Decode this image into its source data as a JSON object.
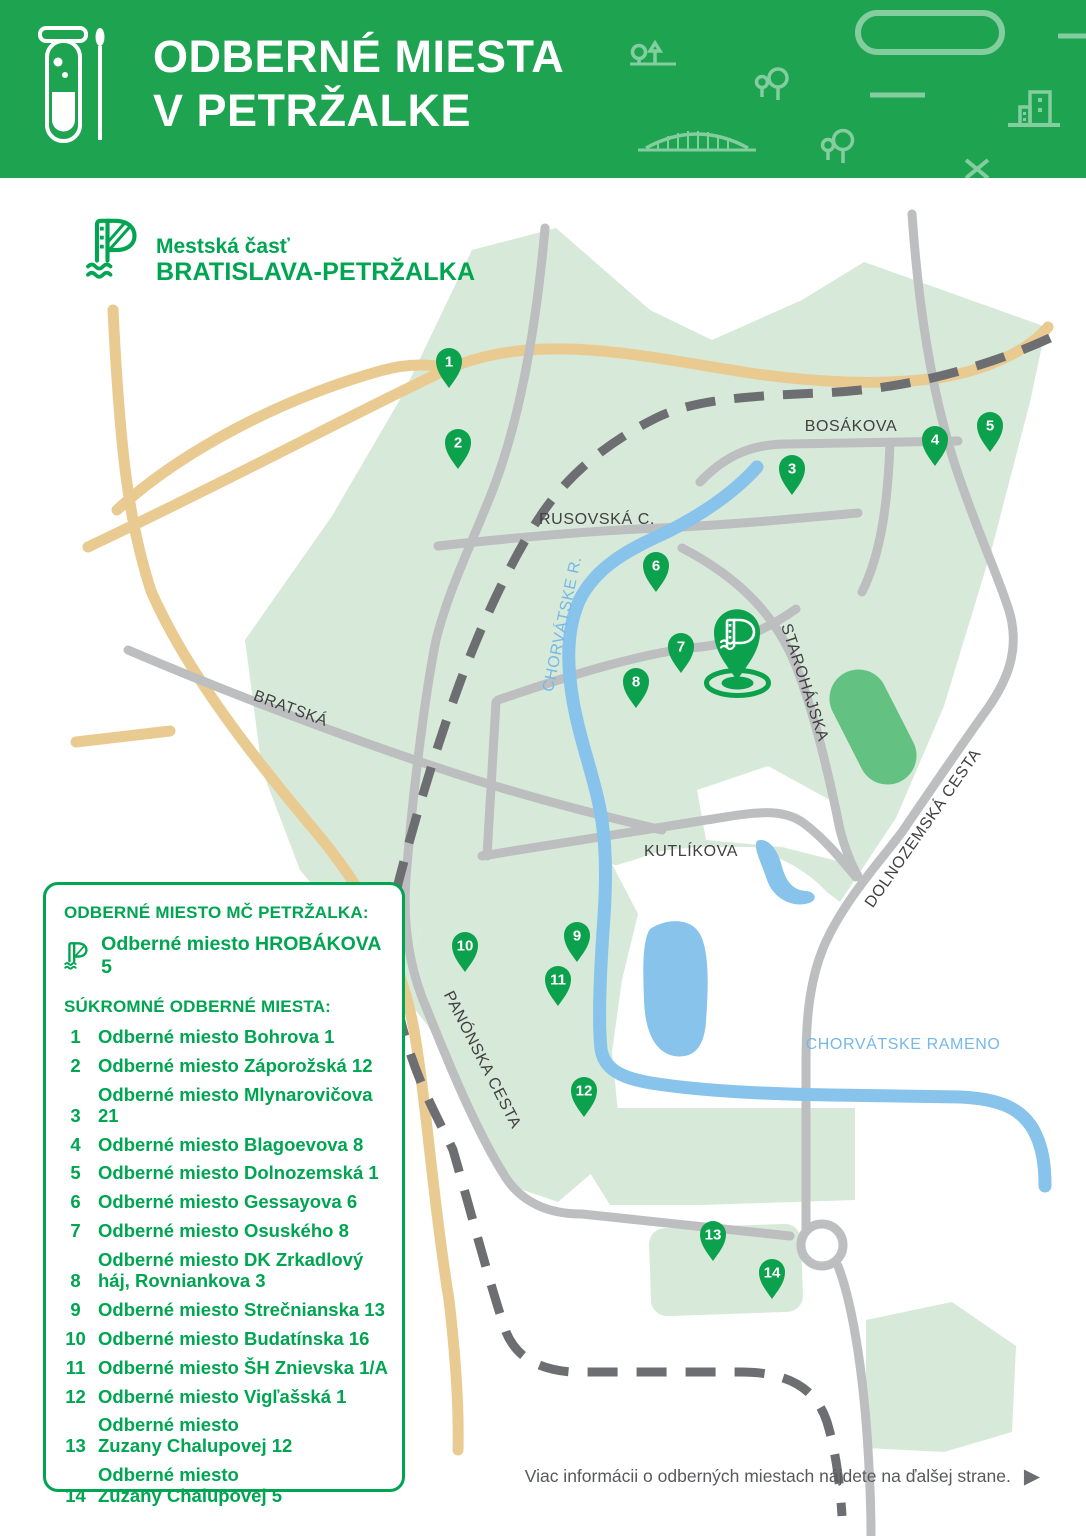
{
  "header": {
    "title_line1": "ODBERNÉ MIESTA",
    "title_line2": "V PETRŽALKE",
    "icons": [
      "test-tube",
      "swab",
      "tree-pine",
      "pill-shape",
      "trees",
      "buildings",
      "bridge",
      "cross-mark"
    ]
  },
  "brand": {
    "name_line1": "Mestská časť",
    "name_line2": "BRATISLAVA-PETRŽALKA"
  },
  "map": {
    "streets": [
      {
        "name": "BOSÁKOVA"
      },
      {
        "name": "RUSOVSKÁ C."
      },
      {
        "name": "BRATSKÁ"
      },
      {
        "name": "STAROHÁJSKA"
      },
      {
        "name": "KUTLÍKOVA"
      },
      {
        "name": "DOLNOZEMSKÁ CESTA"
      },
      {
        "name": "PANÓNSKA CESTA"
      }
    ],
    "waters": [
      {
        "name": "CHORVÁTSKE R."
      },
      {
        "name": "CHORVÁTSKE RAMENO"
      }
    ],
    "pins": [
      {
        "label": "1"
      },
      {
        "label": "2"
      },
      {
        "label": "3"
      },
      {
        "label": "4"
      },
      {
        "label": "5"
      },
      {
        "label": "6"
      },
      {
        "label": "7"
      },
      {
        "label": "8"
      },
      {
        "label": "9"
      },
      {
        "label": "10"
      },
      {
        "label": "11"
      },
      {
        "label": "12"
      },
      {
        "label": "13"
      },
      {
        "label": "14"
      }
    ],
    "main_pin": {
      "icon": "petrzalka-logo-pin"
    }
  },
  "legend": {
    "title_public": "ODBERNÉ MIESTO MČ PETRŽALKA:",
    "public_item": "Odberné miesto HROBÁKOVA 5",
    "title_private": "SÚKROMNÉ ODBERNÉ MIESTA:",
    "items": [
      {
        "num": "1",
        "line1": "Odberné miesto Bohrova 1"
      },
      {
        "num": "2",
        "line1": "Odberné miesto Záporožská 12"
      },
      {
        "num": "3",
        "line1": "Odberné miesto Mlynarovičova 21"
      },
      {
        "num": "4",
        "line1": "Odberné miesto Blagoevova 8"
      },
      {
        "num": "5",
        "line1": "Odberné miesto Dolnozemská 1"
      },
      {
        "num": "6",
        "line1": "Odberné miesto Gessayova 6"
      },
      {
        "num": "7",
        "line1": "Odberné miesto Osuského 8"
      },
      {
        "num": "8",
        "line1": "Odberné miesto DK Zrkadlový",
        "line2": "háj, Rovniankova 3"
      },
      {
        "num": "9",
        "line1": "Odberné miesto Strečnianska 13"
      },
      {
        "num": "10",
        "line1": "Odberné miesto Budatínska 16"
      },
      {
        "num": "11",
        "line1": "Odberné miesto ŠH Znievska 1/A"
      },
      {
        "num": "12",
        "line1": "Odberné miesto Vigľašská 1"
      },
      {
        "num": "13",
        "line1": "Odberné miesto",
        "line2": "Zuzany Chalupovej 12"
      },
      {
        "num": "14",
        "line1": "Odberné miesto",
        "line2": "Zuzany Chalupovej 5"
      }
    ]
  },
  "footer": {
    "note": "Viac informácii o odberných miestach nájdete na ďalšej strane.",
    "arrow": "▶"
  },
  "colors": {
    "header_green": "#1EA351",
    "brand_green": "#00A551",
    "pin_green": "#0CA14C",
    "district_green": "#D7E9D8",
    "park_green": "#63C181",
    "road_gray": "#BCBEC0",
    "border_dash_gray": "#6D6E71",
    "highway_tan": "#E9CB92",
    "water_blue": "#87C3EB",
    "water_label_blue": "#74B9E7",
    "street_label_gray": "#414042",
    "note_gray": "#58595B"
  }
}
